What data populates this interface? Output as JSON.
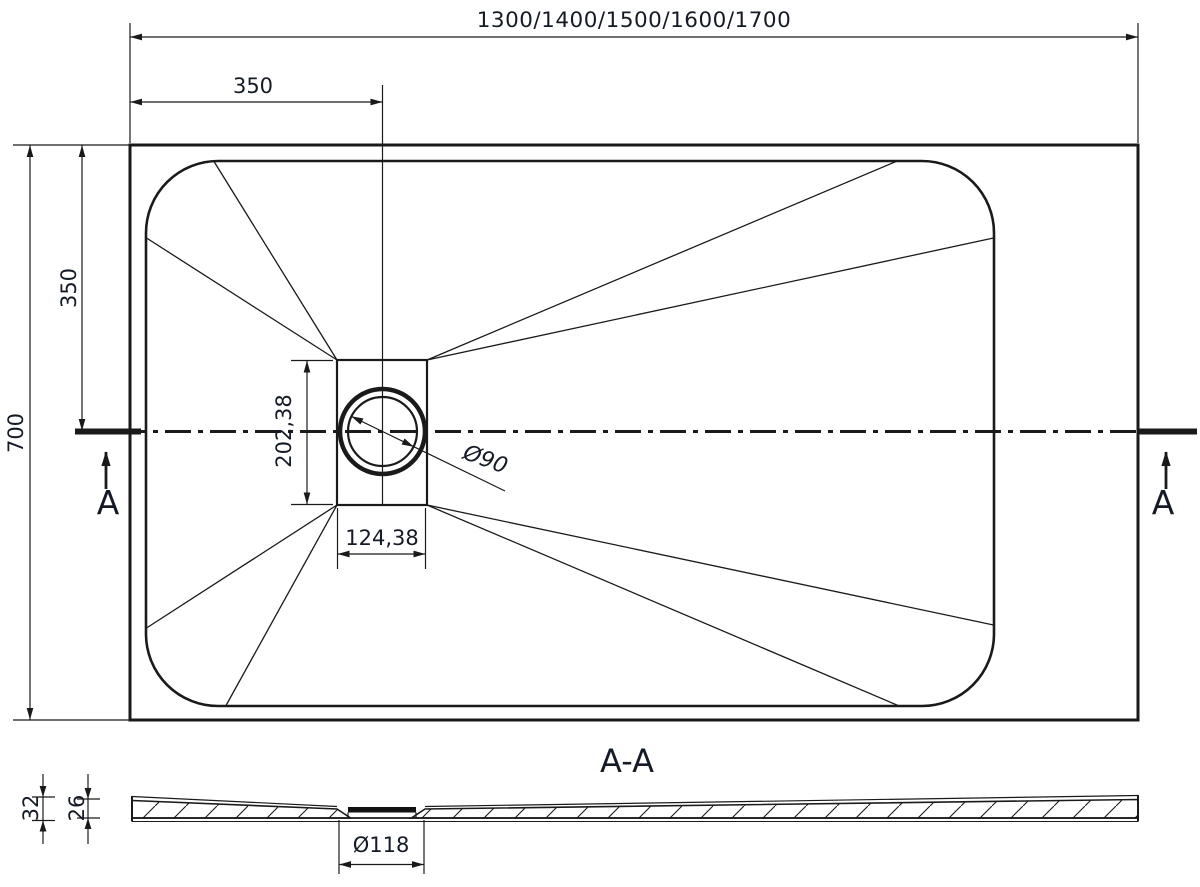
{
  "top_view": {
    "width_options": "1300/1400/1500/1600/1700",
    "drain_offset_from_left": "350",
    "depth": "700",
    "drain_offset_from_top": "350",
    "drain_recess_height": "202,38",
    "drain_recess_width": "124,38",
    "drain_diameter": "Ø90",
    "section_marker_left": "A",
    "section_marker_right": "A"
  },
  "section_view": {
    "title": "A-A",
    "edge_height": "32",
    "body_height": "26",
    "drain_hole_diameter": "Ø118"
  },
  "colors": {
    "line": "#1a1a1a",
    "text": "#151b26",
    "background": "#ffffff"
  }
}
